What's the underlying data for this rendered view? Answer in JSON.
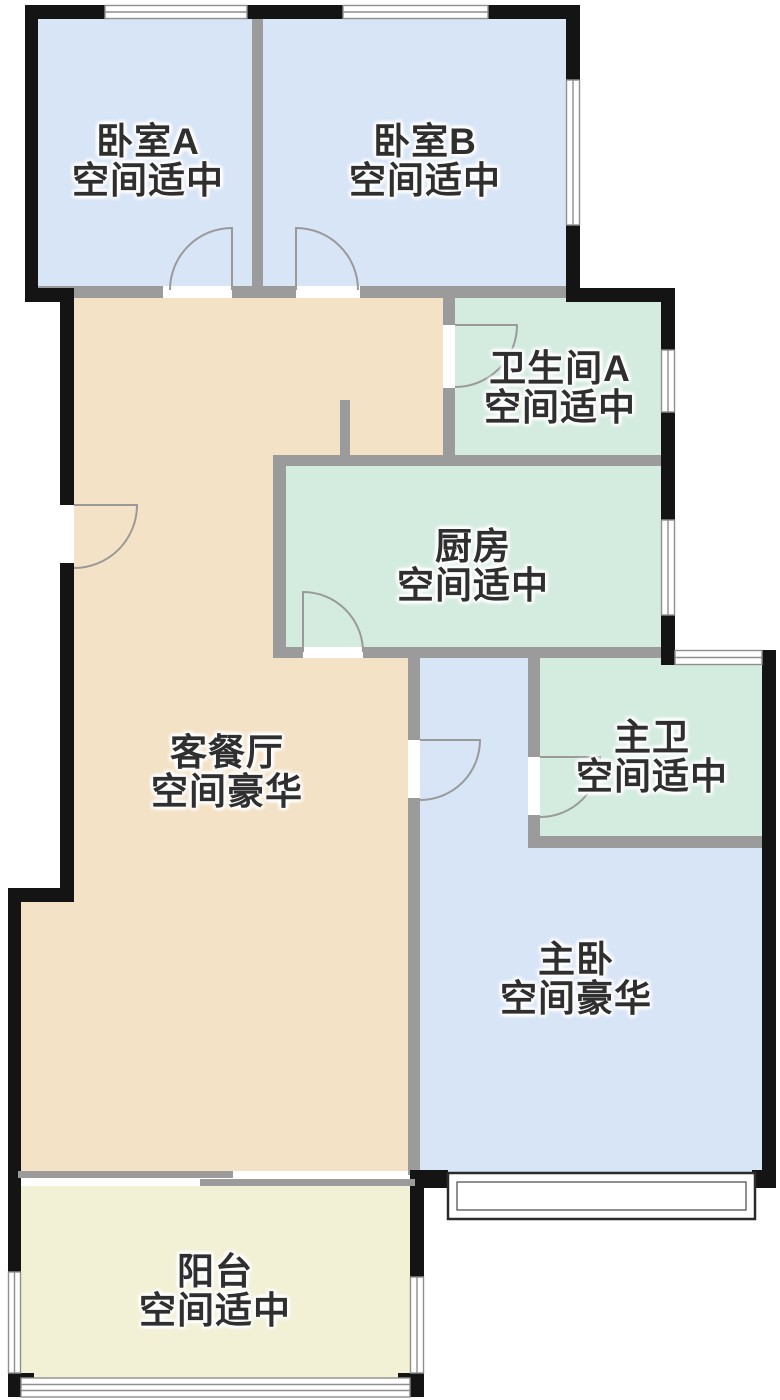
{
  "plan_title": "户型图",
  "rooms": [
    {
      "id": "bedroom-a",
      "name": "卧室A",
      "size_label": "空间适中"
    },
    {
      "id": "bedroom-b",
      "name": "卧室B",
      "size_label": "空间适中"
    },
    {
      "id": "bathroom-a",
      "name": "卫生间A",
      "size_label": "空间适中"
    },
    {
      "id": "kitchen",
      "name": "厨房",
      "size_label": "空间适中"
    },
    {
      "id": "living-dining",
      "name": "客餐厅",
      "size_label": "空间豪华"
    },
    {
      "id": "master-bath",
      "name": "主卫",
      "size_label": "空间适中"
    },
    {
      "id": "master-bedroom",
      "name": "主卧",
      "size_label": "空间豪华"
    },
    {
      "id": "balcony",
      "name": "阳台",
      "size_label": "空间适中"
    }
  ],
  "colors": {
    "background": "#ffffff",
    "bedroom_fill": "#d8e5f7",
    "wet_room_fill": "#d4ece0",
    "living_fill": "#f4e2c6",
    "balcony_fill": "#f2f0d5",
    "wall": "#141414",
    "partition": "#9b9b9b",
    "window_line": "#8f8f8f",
    "door_line": "#9a9a9a",
    "bay_frame": "#2b2b2b",
    "bay_inner": "#555555",
    "gap": "#ffffff",
    "text": "#2f2f2f"
  }
}
